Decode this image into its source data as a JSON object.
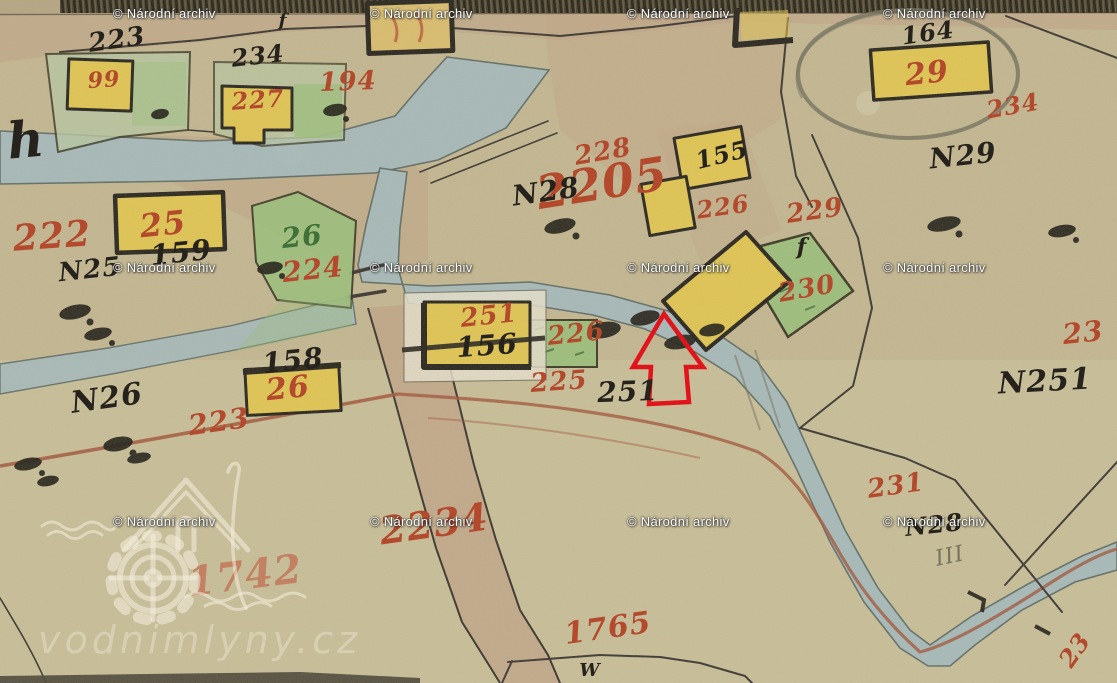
{
  "title": "Historic cadastral map scan (water mill site)",
  "watermarks": {
    "text": "© Národní archiv",
    "positions": [
      [
        113,
        6
      ],
      [
        370,
        6
      ],
      [
        627,
        6
      ],
      [
        883,
        6
      ],
      [
        113,
        260
      ],
      [
        370,
        260
      ],
      [
        627,
        260
      ],
      [
        883,
        260
      ],
      [
        113,
        514
      ],
      [
        370,
        514
      ],
      [
        627,
        514
      ],
      [
        883,
        514
      ]
    ]
  },
  "logo": {
    "text": "vodnimlyny.cz"
  },
  "palette": {
    "paper": "#c5b992",
    "paper_light": "#cdc6a1",
    "road_tint": "#c2a286",
    "stream_fill": "#a7bcbe",
    "stream_edge": "#5c6b66",
    "building_yellow": "#e3c752",
    "building_tan": "#dcbf6e",
    "parcel_green": "#9cc17c",
    "parcel_light": "#b9c9a4",
    "white_parcel": "#e9e3cf",
    "ink": "#26231c",
    "red_number": "#b34a2d",
    "red_faded": "#c06a4e",
    "green_number": "#3f7239",
    "pencil": "#76735f",
    "road_line": "#a3553a",
    "arrow_red": "#e8020c",
    "hatch_dark": "#4a442f",
    "edge_dark": "#4a4537",
    "watermark_white": "#ffffff",
    "logo_white": "rgba(244,239,223,0.58)"
  },
  "map_labels": [
    {
      "id": "parcel-2205",
      "text": "2205",
      "x": 602,
      "y": 183,
      "c": "red",
      "s": 46,
      "r": -9
    },
    {
      "id": "parcel-222",
      "text": "222",
      "x": 52,
      "y": 236,
      "c": "red",
      "s": 36,
      "r": -4
    },
    {
      "id": "house-25",
      "text": "25",
      "x": 163,
      "y": 224,
      "c": "red",
      "s": 32,
      "r": -6
    },
    {
      "id": "parcel-224",
      "text": "224",
      "x": 313,
      "y": 270,
      "c": "red",
      "s": 28,
      "r": -6
    },
    {
      "id": "green-26",
      "text": "26",
      "x": 302,
      "y": 237,
      "c": "green",
      "s": 28,
      "r": -6
    },
    {
      "id": "black-223",
      "text": "223",
      "x": 117,
      "y": 40,
      "c": "black",
      "s": 26,
      "r": -8
    },
    {
      "id": "black-234",
      "text": "234",
      "x": 258,
      "y": 56,
      "c": "black",
      "s": 24,
      "r": -6
    },
    {
      "id": "house-227",
      "text": "227",
      "x": 258,
      "y": 100,
      "c": "red",
      "s": 24,
      "r": -4
    },
    {
      "id": "house-99",
      "text": "99",
      "x": 104,
      "y": 80,
      "c": "red",
      "s": 22,
      "r": -4
    },
    {
      "id": "parcel-194",
      "text": "194",
      "x": 348,
      "y": 82,
      "c": "red",
      "s": 26,
      "r": -2
    },
    {
      "id": "black-164",
      "text": "164",
      "x": 928,
      "y": 33,
      "c": "black",
      "s": 24,
      "r": -8
    },
    {
      "id": "house-29",
      "text": "29",
      "x": 927,
      "y": 74,
      "c": "red",
      "s": 30,
      "r": -6
    },
    {
      "id": "parcel-234",
      "text": "234",
      "x": 1013,
      "y": 106,
      "c": "red",
      "s": 24,
      "r": -10
    },
    {
      "id": "n29",
      "text": "N29",
      "x": 963,
      "y": 156,
      "c": "black",
      "s": 28,
      "r": -6
    },
    {
      "id": "parcel-228",
      "text": "228",
      "x": 603,
      "y": 152,
      "c": "red",
      "s": 26,
      "r": -10
    },
    {
      "id": "n28",
      "text": "N28",
      "x": 546,
      "y": 192,
      "c": "black",
      "s": 28,
      "r": -8
    },
    {
      "id": "black-155",
      "text": "155",
      "x": 722,
      "y": 155,
      "c": "black",
      "s": 24,
      "r": -14
    },
    {
      "id": "parcel-226a",
      "text": "226",
      "x": 723,
      "y": 207,
      "c": "red",
      "s": 24,
      "r": -8
    },
    {
      "id": "parcel-229",
      "text": "229",
      "x": 815,
      "y": 211,
      "c": "red",
      "s": 26,
      "r": -8
    },
    {
      "id": "parcel-230",
      "text": "230",
      "x": 807,
      "y": 289,
      "c": "red",
      "s": 26,
      "r": -10
    },
    {
      "id": "f-mark-1",
      "text": "f",
      "x": 802,
      "y": 247,
      "c": "black",
      "s": 22,
      "r": 0
    },
    {
      "id": "f-mark-2",
      "text": "f",
      "x": 283,
      "y": 21,
      "c": "black",
      "s": 18,
      "r": 0
    },
    {
      "id": "black-159",
      "text": "159",
      "x": 181,
      "y": 253,
      "c": "black",
      "s": 28,
      "r": -6
    },
    {
      "id": "n25",
      "text": "N25",
      "x": 90,
      "y": 270,
      "c": "black",
      "s": 26,
      "r": -6
    },
    {
      "id": "house-251a",
      "text": "251",
      "x": 489,
      "y": 316,
      "c": "red",
      "s": 26,
      "r": -6
    },
    {
      "id": "black-156",
      "text": "156",
      "x": 487,
      "y": 346,
      "c": "black",
      "s": 28,
      "r": -4
    },
    {
      "id": "parcel-226b",
      "text": "226",
      "x": 576,
      "y": 334,
      "c": "red",
      "s": 26,
      "r": -6
    },
    {
      "id": "parcel-225",
      "text": "225",
      "x": 559,
      "y": 382,
      "c": "red",
      "s": 26,
      "r": -4
    },
    {
      "id": "black-251",
      "text": "251",
      "x": 628,
      "y": 392,
      "c": "black",
      "s": 28,
      "r": -2
    },
    {
      "id": "black-158",
      "text": "158",
      "x": 293,
      "y": 361,
      "c": "black",
      "s": 28,
      "r": -6
    },
    {
      "id": "house-26",
      "text": "26",
      "x": 288,
      "y": 389,
      "c": "red",
      "s": 30,
      "r": -6
    },
    {
      "id": "n26",
      "text": "N26",
      "x": 107,
      "y": 399,
      "c": "black",
      "s": 30,
      "r": -8
    },
    {
      "id": "parcel-223",
      "text": "223",
      "x": 219,
      "y": 422,
      "c": "red",
      "s": 28,
      "r": -8
    },
    {
      "id": "parcel-23-right",
      "text": "23",
      "x": 1083,
      "y": 333,
      "c": "red",
      "s": 28,
      "r": -6
    },
    {
      "id": "n251",
      "text": "N251",
      "x": 1045,
      "y": 382,
      "c": "black",
      "s": 30,
      "r": -3
    },
    {
      "id": "parcel-231",
      "text": "231",
      "x": 896,
      "y": 486,
      "c": "red",
      "s": 26,
      "r": -8
    },
    {
      "id": "n28-lower",
      "text": "N28",
      "x": 934,
      "y": 525,
      "c": "black",
      "s": 24,
      "r": -6
    },
    {
      "id": "pencil-iii",
      "text": "III",
      "x": 950,
      "y": 557,
      "c": "pencil",
      "s": 22,
      "r": -12
    },
    {
      "id": "parcel-2234",
      "text": "2234",
      "x": 434,
      "y": 524,
      "c": "red",
      "s": 38,
      "r": -8
    },
    {
      "id": "parcel-1742",
      "text": "1742",
      "x": 245,
      "y": 576,
      "c": "redlight",
      "s": 40,
      "r": -7
    },
    {
      "id": "parcel-1765",
      "text": "1765",
      "x": 608,
      "y": 629,
      "c": "red",
      "s": 30,
      "r": -8
    },
    {
      "id": "w-mark",
      "text": "W",
      "x": 590,
      "y": 671,
      "c": "black",
      "s": 18,
      "r": 0
    },
    {
      "id": "h-mark",
      "text": "h",
      "x": 26,
      "y": 140,
      "c": "black",
      "s": 50,
      "r": -5
    },
    {
      "id": "parcel-23-bottom",
      "text": "23",
      "x": 1075,
      "y": 650,
      "c": "red",
      "s": 24,
      "r": -55
    }
  ]
}
